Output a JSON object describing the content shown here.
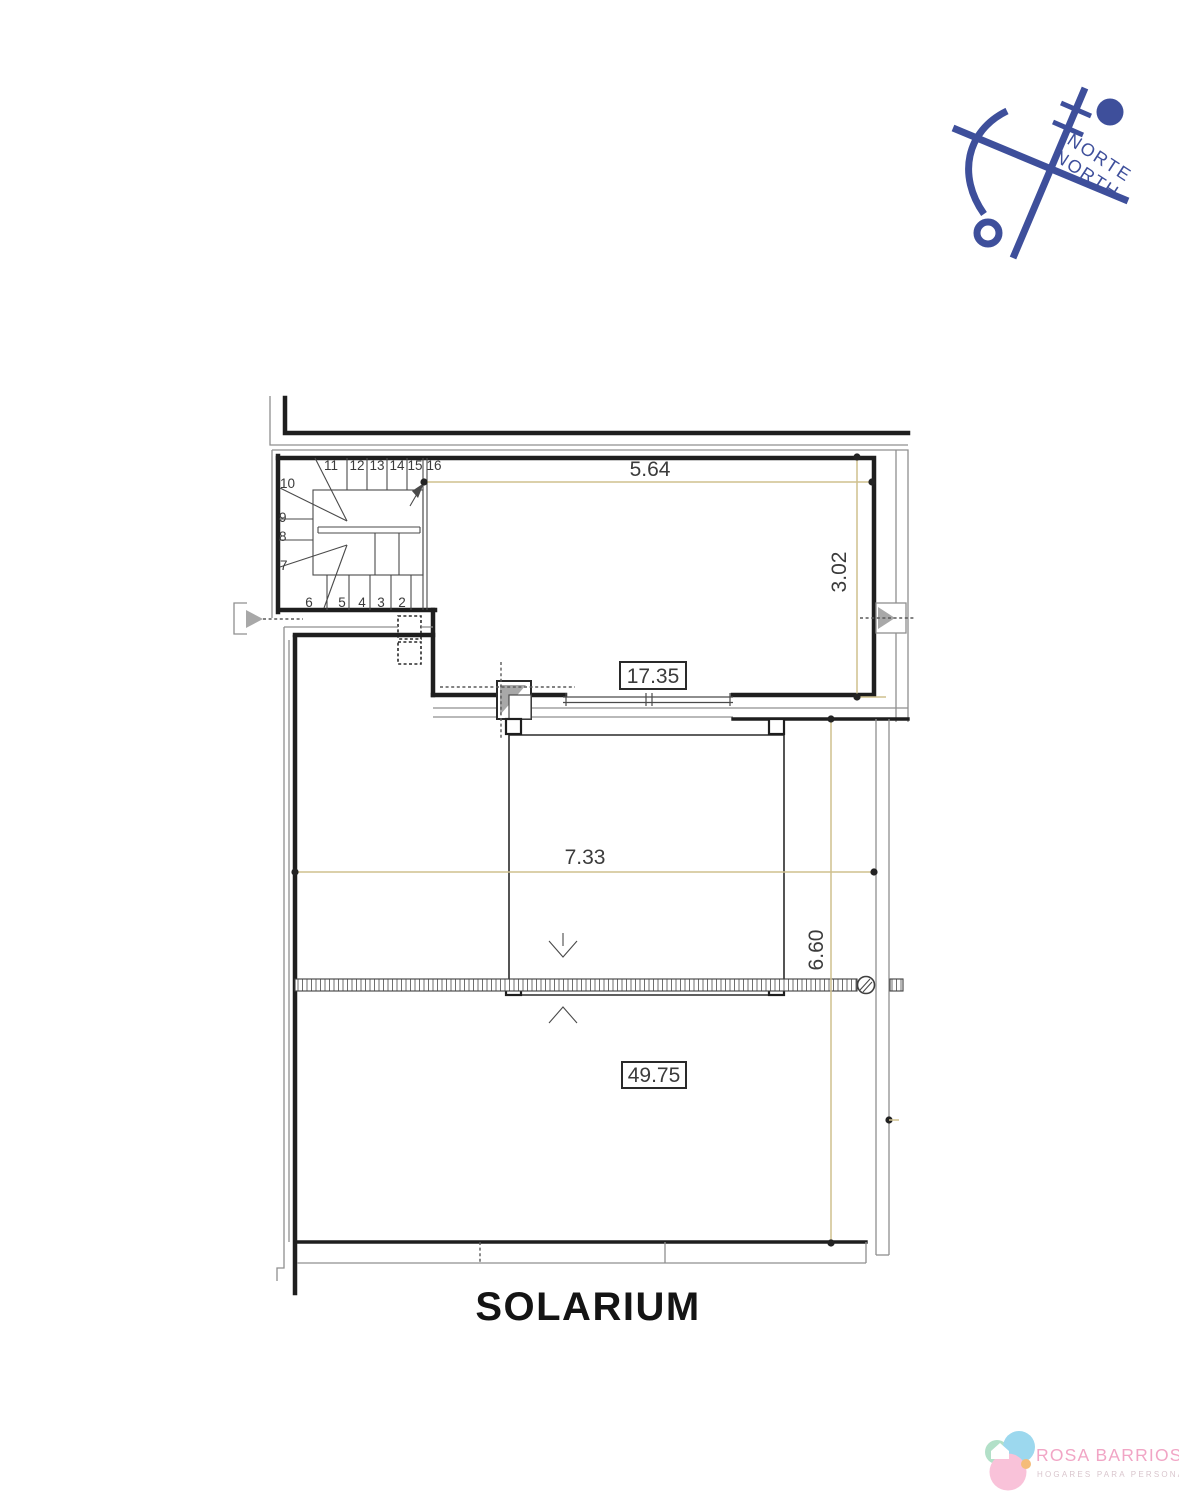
{
  "plan_title": "SOLARIUM",
  "north_indicator": {
    "label_primary": "NORTE",
    "label_secondary": "NORTH",
    "color": "#3e4f9b"
  },
  "dimensions": {
    "upper_room_width": "5.64",
    "upper_room_depth": "3.02",
    "upper_room_area": "17.35",
    "terrace_width": "7.33",
    "terrace_depth": "6.60",
    "terrace_area": "49.75"
  },
  "staircase": {
    "top_steps": [
      "11",
      "12",
      "13",
      "14",
      "15",
      "16"
    ],
    "left_steps": [
      "10",
      "9",
      "8",
      "7"
    ],
    "bottom_steps": [
      "6",
      "5",
      "4",
      "3",
      "2"
    ]
  },
  "branding": {
    "name": "ROSA BARRIOS",
    "tagline": "HOGARES PARA PERSONAS",
    "name_color": "#f1a5c5",
    "tagline_color": "#d9c6cd",
    "logo_colors": {
      "green": "#b2e0c8",
      "blue": "#9cd8ee",
      "pink": "#f9c2d9",
      "orange": "#f5bc79"
    }
  },
  "drawing_colors": {
    "wall_line": "#1e1e1e",
    "thin_line": "#8f8f8f",
    "dimension_line": "#cfc08e",
    "dimension_text": "#3b3b3b"
  }
}
